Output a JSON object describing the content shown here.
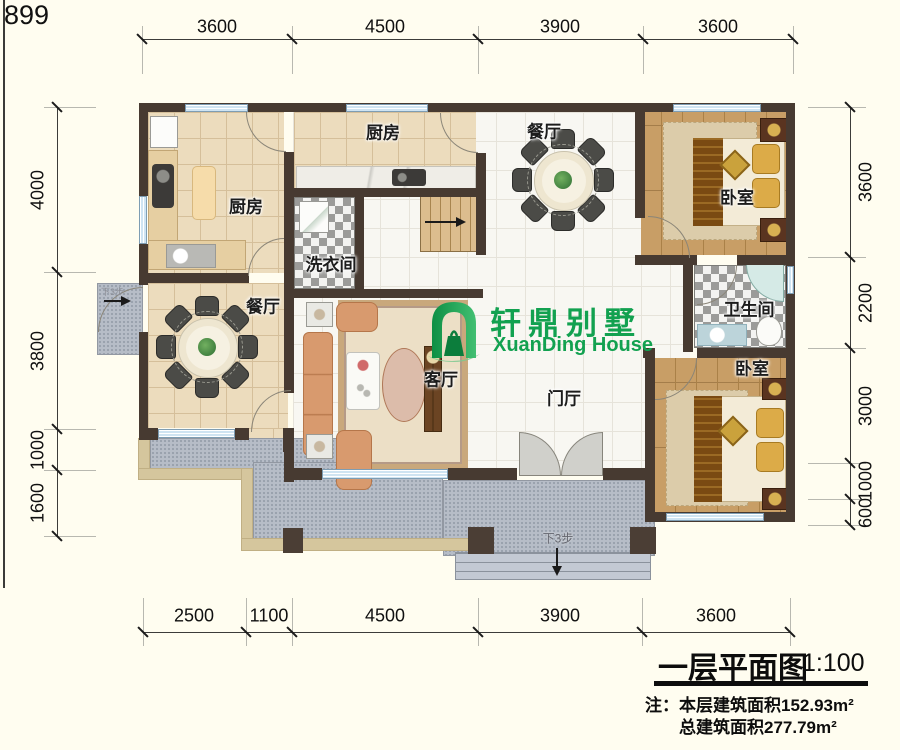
{
  "page": {
    "corner_number": "899"
  },
  "logo": {
    "name_cn": "轩鼎别墅",
    "name_en": "XuanDing House",
    "color": "#12a150"
  },
  "title_block": {
    "title": "一层平面图",
    "scale": "1:100",
    "note_line1": "注：本层建筑面积152.93m²",
    "note_line2": "总建筑面积277.79m²"
  },
  "rooms": {
    "kitchen_left": "厨房",
    "kitchen_top": "厨房",
    "dining_top": "餐厅",
    "dining_left": "餐厅",
    "laundry": "洗衣间",
    "living": "客厅",
    "foyer": "门厅",
    "bedroom_top": "卧室",
    "bedroom_bottom": "卧室",
    "bathroom": "卫生间"
  },
  "annotations": {
    "front_steps": "下3步",
    "side_steps": "下3步"
  },
  "dimensions": {
    "top": [
      "3600",
      "4500",
      "3900",
      "3600"
    ],
    "bottom": [
      "2500",
      "1100",
      "4500",
      "3900",
      "3600"
    ],
    "left": [
      "4000",
      "3800",
      "1000",
      "1600"
    ],
    "right": [
      "3600",
      "2200",
      "3000",
      "1000",
      "600"
    ]
  }
}
